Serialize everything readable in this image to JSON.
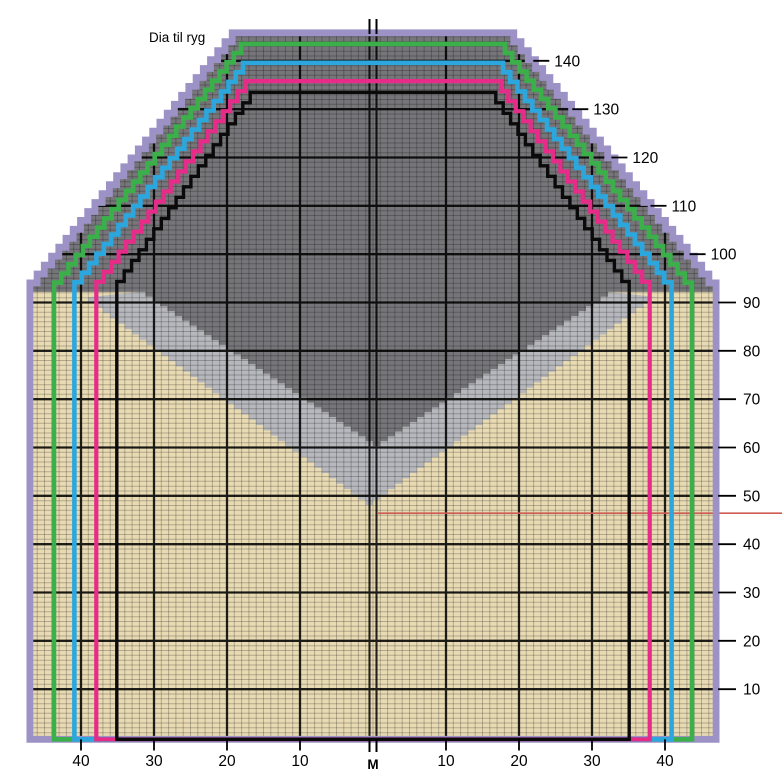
{
  "title": "Dia til ryg",
  "canvas": {
    "width": 782,
    "height": 774,
    "background": "#ffffff"
  },
  "chart_data": {
    "type": "knitting-grid",
    "description": "Stepped garment back chart, 5 nested size outlines, gray diamond motif",
    "origin_x": 373,
    "origin_y": 737.5,
    "cell_w": 7.3,
    "cell_h": 4.8333,
    "underarm_row": 92.2,
    "fine_grid": {
      "half_cols": 47,
      "rows": 146,
      "color": "rgba(0,0,0,0.23)"
    },
    "major_grid": {
      "row_step": 10,
      "max_row": 140,
      "col_step": 10,
      "max_col": 40,
      "color": "#000000",
      "width": 2.3,
      "opacity": 0.85,
      "center_double_offset_st": 0.48,
      "center_width": 2.1
    },
    "fills": {
      "tan": "#e8dab3",
      "dark_gray": "#76767a",
      "light_gray": "#b6b8bd",
      "dark_region": {
        "apex_st": 0,
        "apex_row": 60.3,
        "edge_half_span_st": 32.2,
        "edge_row": 92.2
      },
      "light_region": {
        "apex_st": 0,
        "apex_row": 48.1,
        "edge_half_span_st": 39.0,
        "edge_row": 91.1
      }
    },
    "sizes": [
      {
        "name": "size-xl-outline",
        "color": "#9c92c6",
        "stroke_width": 6.8,
        "half_width_st": 47.0,
        "top_half_width_st": 18.3,
        "top_row": 145.8
      },
      {
        "name": "size-l-outline",
        "color": "#3bb04a",
        "stroke_width": 4.6,
        "half_width_st": 43.7,
        "top_half_width_st": 17.1,
        "top_row": 143.5
      },
      {
        "name": "size-m-outline",
        "color": "#2ba7de",
        "stroke_width": 4.6,
        "half_width_st": 40.9,
        "top_half_width_st": 16.8,
        "top_row": 139.6
      },
      {
        "name": "size-s-outline",
        "color": "#e62b88",
        "stroke_width": 4.2,
        "half_width_st": 37.9,
        "top_half_width_st": 16.5,
        "top_row": 135.8
      },
      {
        "name": "size-xs-outline",
        "color": "#0a0a0a",
        "stroke_width": 3.4,
        "half_width_st": 35.1,
        "top_half_width_st": 15.8,
        "top_row": 133.5
      }
    ],
    "red_marker_line": {
      "row": 46.4,
      "x_start_st": 0.7,
      "x_end_px": 782,
      "color": "#cf5c52",
      "width": 1.6
    },
    "row_labels_diagonal": [
      {
        "row": 140,
        "text": "140"
      },
      {
        "row": 130,
        "text": "130"
      },
      {
        "row": 120,
        "text": "120"
      },
      {
        "row": 110,
        "text": "110"
      },
      {
        "row": 100,
        "text": "100"
      }
    ],
    "row_labels_edge": [
      {
        "row": 90,
        "text": "90"
      },
      {
        "row": 80,
        "text": "80"
      },
      {
        "row": 70,
        "text": "70"
      },
      {
        "row": 60,
        "text": "60"
      },
      {
        "row": 50,
        "text": "50"
      },
      {
        "row": 40,
        "text": "40"
      },
      {
        "row": 30,
        "text": "30"
      },
      {
        "row": 20,
        "text": "20"
      },
      {
        "row": 10,
        "text": "10"
      }
    ],
    "stitch_labels": [
      {
        "st": -40,
        "text": "40"
      },
      {
        "st": -30,
        "text": "30"
      },
      {
        "st": -20,
        "text": "20"
      },
      {
        "st": -10,
        "text": "10"
      },
      {
        "st": 0,
        "text": "M"
      },
      {
        "st": 10,
        "text": "10"
      },
      {
        "st": 20,
        "text": "20"
      },
      {
        "st": 30,
        "text": "30"
      },
      {
        "st": 40,
        "text": "40"
      }
    ],
    "center_mark": {
      "top_tick": true,
      "bottom_tick": true,
      "double_line": true
    }
  }
}
